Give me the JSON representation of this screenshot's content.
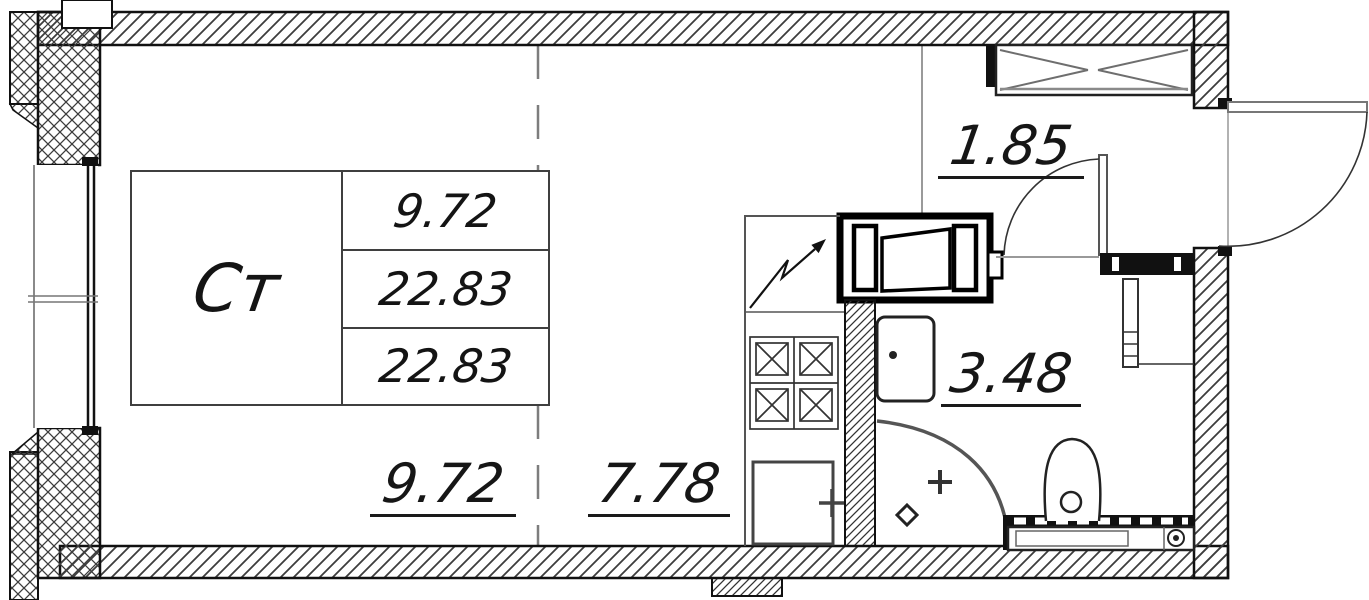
{
  "apartment_table": {
    "type_label": "Ст",
    "area_rows": [
      "9.72",
      "22.83",
      "22.83"
    ]
  },
  "dimensions": {
    "hallway": "1.85",
    "bathroom": "3.48",
    "living_zone": "9.72",
    "kitchen_zone": "7.78"
  },
  "colors": {
    "ink": "#1a1a1a",
    "wall_hatch": "#3d3d3d",
    "muted": "#888888",
    "background": "#ffffff"
  },
  "fixtures": [
    "window",
    "wardrobe",
    "entrance-door",
    "bathroom-door",
    "vent-shaft",
    "stove",
    "kitchen-sink",
    "bathroom-sink",
    "shower",
    "toilet",
    "bathtub",
    "towel-rail"
  ]
}
